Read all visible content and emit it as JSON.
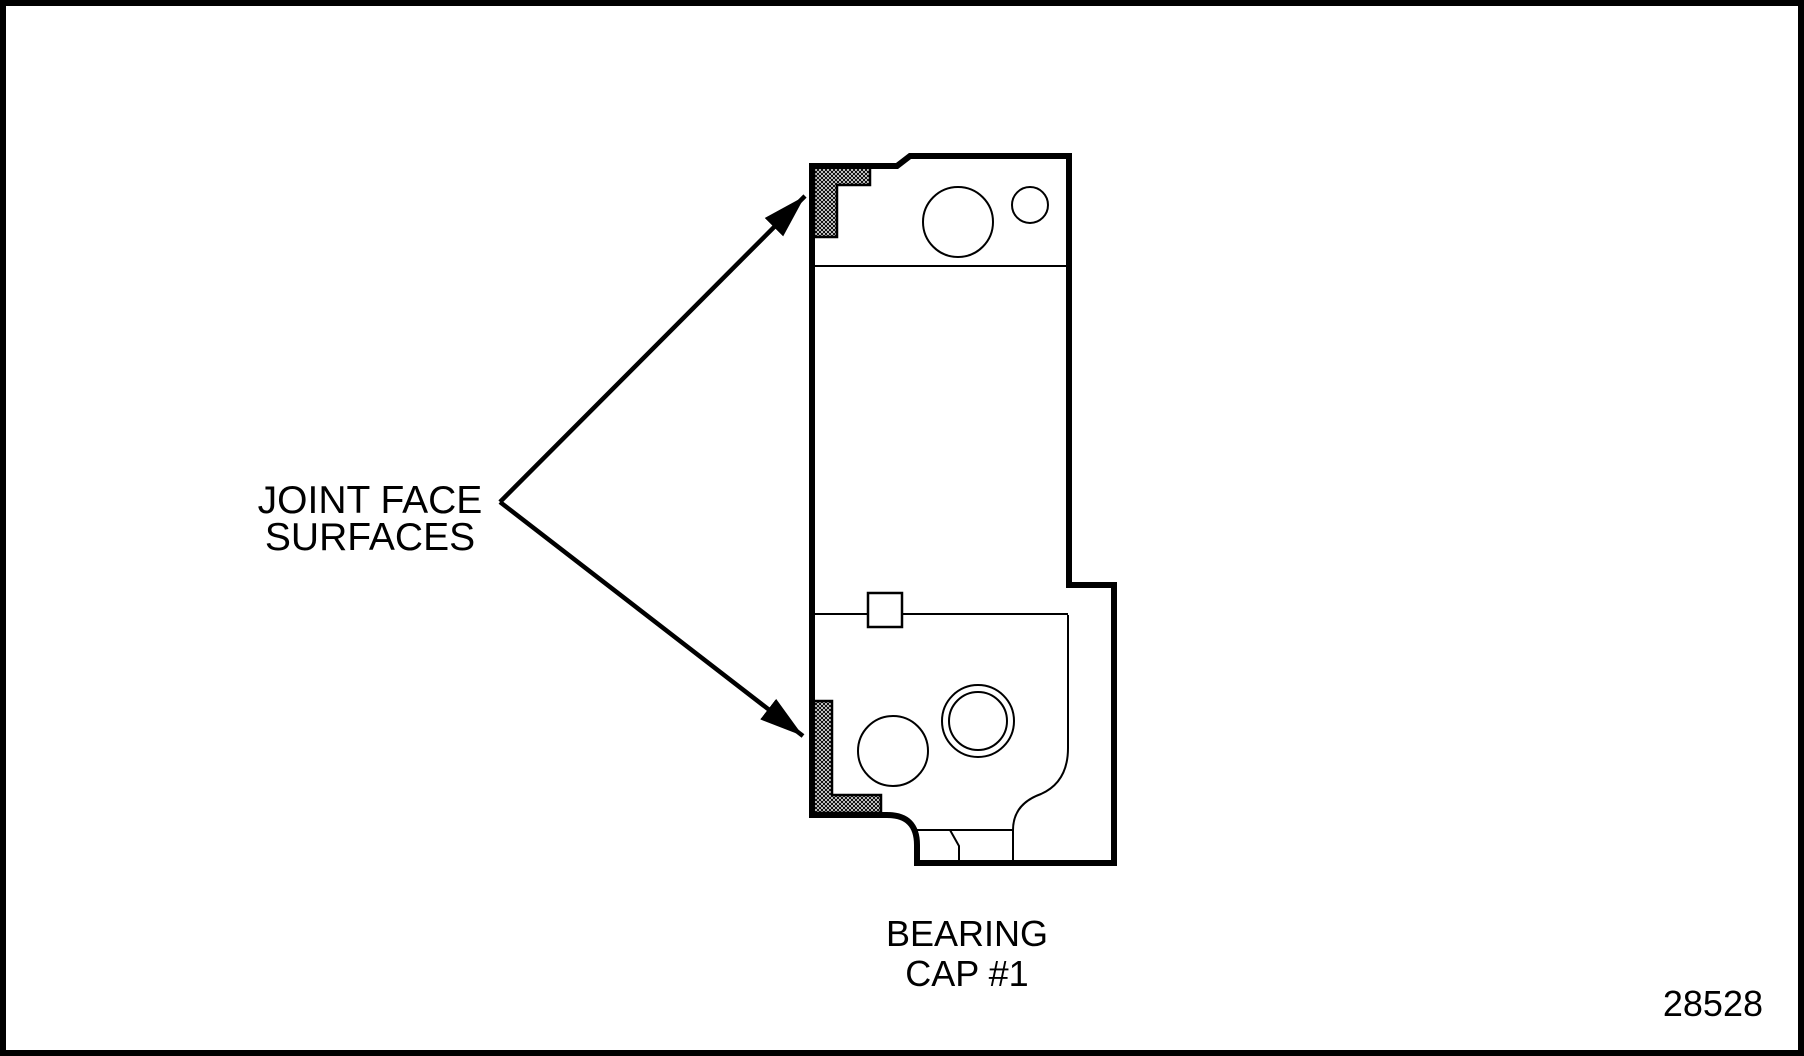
{
  "figure": {
    "callout": {
      "line1": "JOINT FACE",
      "line2": "SURFACES"
    },
    "part_label": {
      "line1": "BEARING",
      "line2": "CAP #1"
    },
    "figure_number": "28528",
    "colors": {
      "ink": "#000000",
      "background": "#ffffff"
    }
  }
}
